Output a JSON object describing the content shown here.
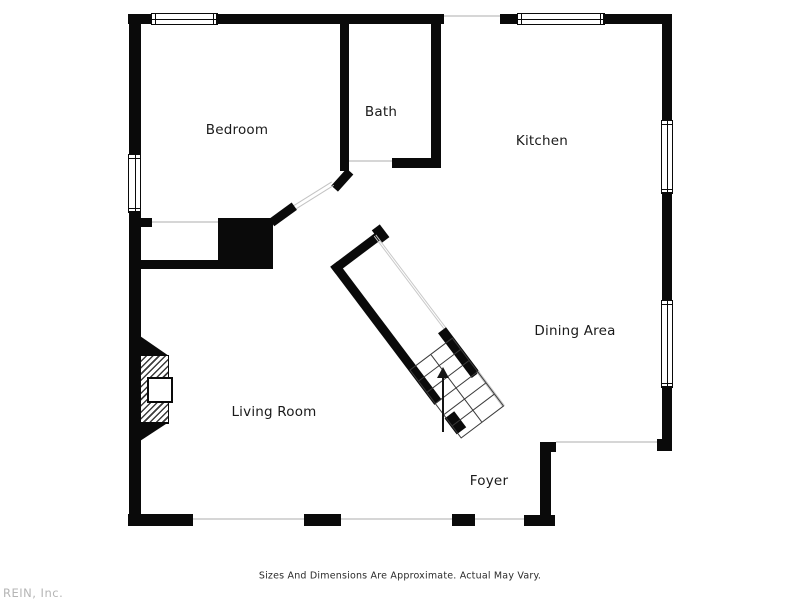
{
  "rooms": {
    "bedroom": {
      "label": "Bedroom"
    },
    "bath": {
      "label": "Bath"
    },
    "kitchen": {
      "label": "Kitchen"
    },
    "dining_area": {
      "label": "Dining Area"
    },
    "living_room": {
      "label": "Living Room"
    },
    "foyer": {
      "label": "Foyer"
    }
  },
  "stairs": {
    "direction_icon": "up-arrow"
  },
  "footer": {
    "disclaimer": "Sizes And Dimensions Are Approximate. Actual May Vary.",
    "watermark": "REIN, Inc."
  },
  "colors": {
    "wall": "#0a0a0a",
    "background": "#ffffff",
    "opening_line": "#d6d6d6",
    "label_text": "#1a1a1a",
    "watermark_text": "#b5b5b5"
  }
}
